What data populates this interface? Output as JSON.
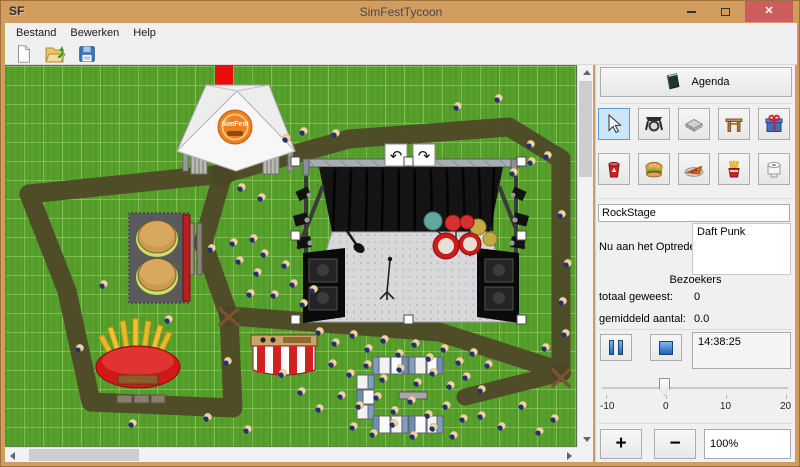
{
  "window": {
    "app_initials": "SF",
    "title": "SimFestTycoon"
  },
  "menu": {
    "items": [
      "Bestand",
      "Bewerken",
      "Help"
    ]
  },
  "toolbar": {
    "buttons": [
      "new-file",
      "open-file",
      "save-file"
    ]
  },
  "sidebar": {
    "agenda_label": "Agenda",
    "tools_row1": [
      "select-cursor",
      "spotlight",
      "stage-platform",
      "gate",
      "gift-shop"
    ],
    "tools_row2": [
      "trashcan",
      "burger-stand",
      "pizza-stand",
      "fries-stand",
      "toilet"
    ],
    "selected_tool": "select-cursor",
    "stage_name_value": "RockStage",
    "now_performing_label": "Nu aan het Optreden:",
    "now_performing_value": "Daft Punk",
    "visitors_header": "Bezoekers",
    "total_label": "totaal geweest:",
    "total_value": "0",
    "average_label": "gemiddeld aantal:",
    "average_value": "0.0",
    "time_value": "14:38:25",
    "slider": {
      "min": -10,
      "max": 20,
      "value": 0,
      "tick_labels": [
        "-10",
        "0",
        "10",
        "20"
      ]
    },
    "zoom_in_label": "+",
    "zoom_out_label": "−",
    "zoom_value": "100%"
  },
  "map": {
    "logo_text": "SimFest",
    "selected_object": "RockStage",
    "venues": [
      "entrance-tent",
      "rock-stage",
      "burger-stand",
      "fries-stand",
      "food-tent",
      "toilet-containers"
    ],
    "people": [
      [
        497,
        97
      ],
      [
        456,
        105
      ],
      [
        529,
        143
      ],
      [
        546,
        154
      ],
      [
        530,
        160
      ],
      [
        512,
        171
      ],
      [
        560,
        213
      ],
      [
        334,
        132
      ],
      [
        302,
        130
      ],
      [
        285,
        137
      ],
      [
        240,
        186
      ],
      [
        260,
        196
      ],
      [
        566,
        262
      ],
      [
        561,
        300
      ],
      [
        544,
        346
      ],
      [
        564,
        332
      ],
      [
        210,
        247
      ],
      [
        232,
        241
      ],
      [
        252,
        237
      ],
      [
        263,
        252
      ],
      [
        238,
        259
      ],
      [
        256,
        271
      ],
      [
        284,
        263
      ],
      [
        292,
        282
      ],
      [
        273,
        293
      ],
      [
        249,
        292
      ],
      [
        302,
        302
      ],
      [
        312,
        288
      ],
      [
        318,
        330
      ],
      [
        334,
        341
      ],
      [
        352,
        333
      ],
      [
        367,
        347
      ],
      [
        383,
        338
      ],
      [
        398,
        352
      ],
      [
        414,
        342
      ],
      [
        428,
        356
      ],
      [
        443,
        347
      ],
      [
        458,
        360
      ],
      [
        472,
        351
      ],
      [
        487,
        363
      ],
      [
        331,
        362
      ],
      [
        349,
        372
      ],
      [
        366,
        363
      ],
      [
        382,
        377
      ],
      [
        399,
        367
      ],
      [
        416,
        381
      ],
      [
        432,
        371
      ],
      [
        449,
        384
      ],
      [
        465,
        375
      ],
      [
        480,
        388
      ],
      [
        340,
        394
      ],
      [
        358,
        404
      ],
      [
        376,
        395
      ],
      [
        393,
        409
      ],
      [
        410,
        399
      ],
      [
        427,
        413
      ],
      [
        445,
        404
      ],
      [
        462,
        417
      ],
      [
        352,
        425
      ],
      [
        372,
        432
      ],
      [
        392,
        422
      ],
      [
        412,
        434
      ],
      [
        432,
        426
      ],
      [
        452,
        434
      ],
      [
        480,
        414
      ],
      [
        500,
        425
      ],
      [
        521,
        404
      ],
      [
        538,
        430
      ],
      [
        553,
        417
      ],
      [
        78,
        347
      ],
      [
        102,
        283
      ],
      [
        131,
        422
      ],
      [
        167,
        318
      ],
      [
        206,
        416
      ],
      [
        246,
        428
      ],
      [
        226,
        360
      ],
      [
        281,
        372
      ],
      [
        300,
        390
      ],
      [
        318,
        407
      ]
    ]
  },
  "colors": {
    "titlebar": "#d09d5e",
    "close_button": "#cd5c5c",
    "selected_tool_bg": "#cbe6fa",
    "grass": "#57a02c",
    "path": "#4e4a28",
    "carpet": "#e80c0c",
    "accent_blue": "#1d62b4"
  }
}
